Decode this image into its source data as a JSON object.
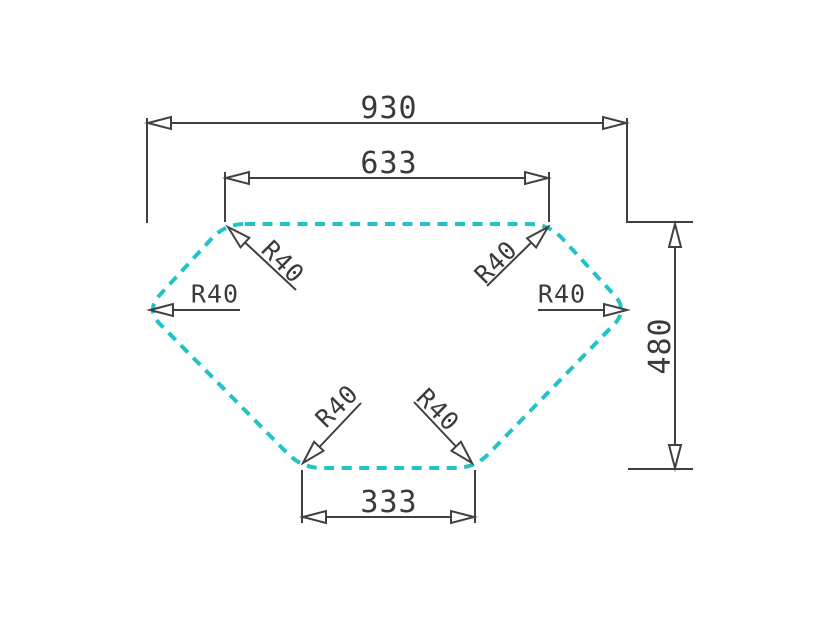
{
  "drawing": {
    "colors": {
      "outline": "#21c3c6",
      "dimension_lines": "#404040",
      "text": "#3a3a3a",
      "background": "#ffffff"
    },
    "dimensions": {
      "overall_width": "930",
      "top_edge_width": "633",
      "bottom_edge_width": "333",
      "overall_height": "480"
    },
    "radii": {
      "top_left": "R40",
      "top_right": "R40",
      "left": "R40",
      "right": "R40",
      "bottom_left": "R40",
      "bottom_right": "R40"
    }
  }
}
